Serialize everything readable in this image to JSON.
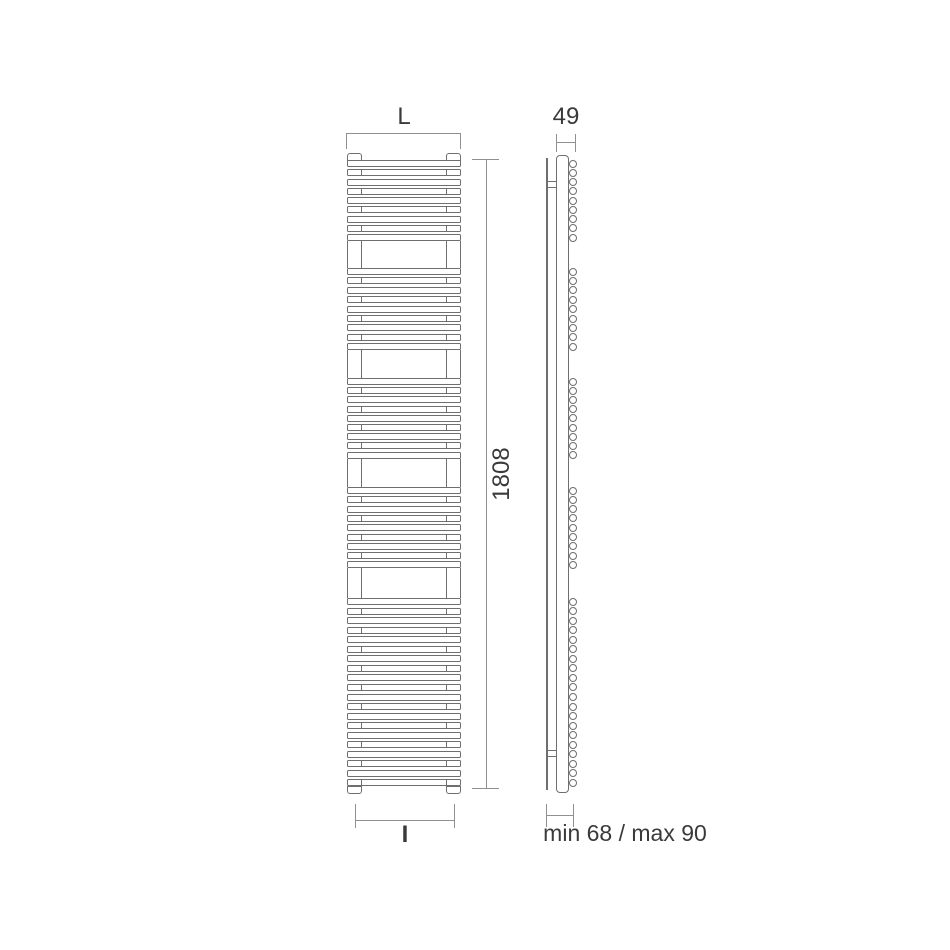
{
  "labels": {
    "width_label": "L",
    "height_value": "1808",
    "depth_value": "49",
    "interaxis_label": "I",
    "wall_distance": "min 68 / max 90"
  },
  "front_view": {
    "left": 347,
    "width": 114,
    "tube_height": 7,
    "collector_width": 15,
    "collector_right_left": 446,
    "cap_top": 153,
    "tube_groups": [
      {
        "count": 9,
        "top": 160,
        "pitch": 9.25
      },
      {
        "count": 9,
        "top": 268,
        "pitch": 9.4
      },
      {
        "count": 9,
        "top": 378,
        "pitch": 9.2
      },
      {
        "count": 9,
        "top": 487,
        "pitch": 9.3
      },
      {
        "count": 20,
        "top": 598,
        "pitch": 9.55
      }
    ]
  },
  "side_view": {
    "circle_left": 569,
    "circle_size": 8,
    "bracket_tops": [
      181,
      750
    ]
  },
  "colors": {
    "line": "#6f6f6f",
    "dim": "#909090",
    "text": "#3a3a3a",
    "background": "#ffffff"
  }
}
